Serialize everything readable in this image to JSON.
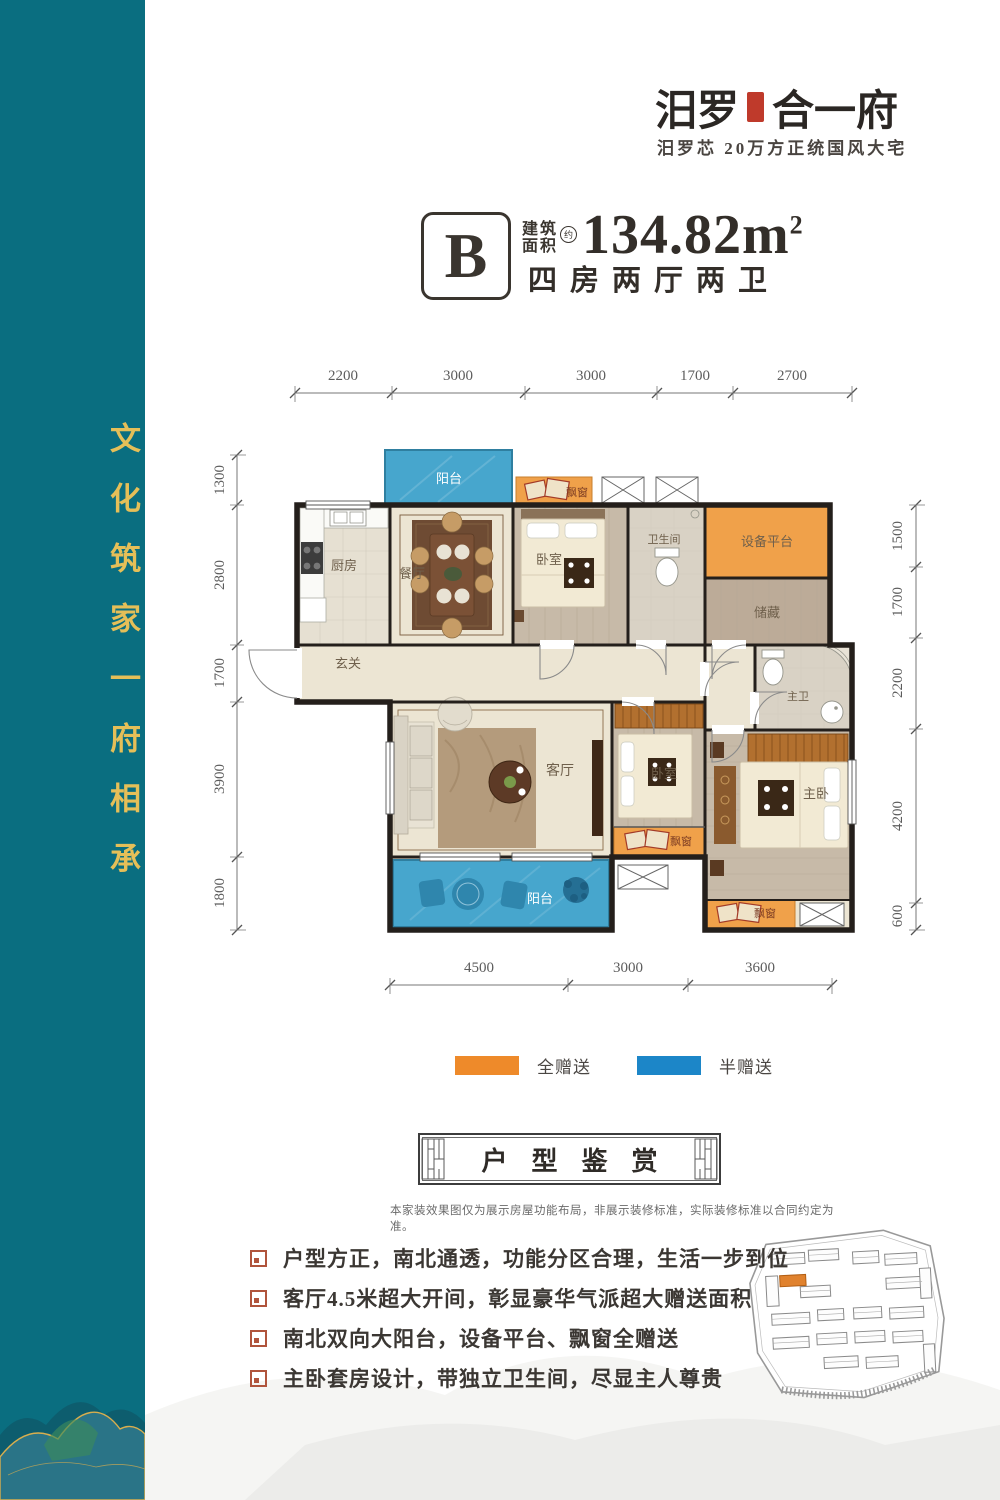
{
  "brand": {
    "logo_left": "汨罗",
    "logo_right": "合一府",
    "tagline": "汨罗芯 20万方正统国风大宅"
  },
  "unit": {
    "type_letter": "B",
    "area_prefix_top": "建筑",
    "area_prefix_bottom": "面积",
    "approx": "约",
    "area_value": "134.82m",
    "area_exponent": "2",
    "layout_text": "四房两厅两卫"
  },
  "sidebar": {
    "slogan": "文化筑家一府相承"
  },
  "plan": {
    "dims": {
      "top": [
        "2200",
        "3000",
        "3000",
        "1700",
        "2700"
      ],
      "left": [
        "1300",
        "2800",
        "1700",
        "3900",
        "1800"
      ],
      "right": [
        "1500",
        "1700",
        "2200",
        "4200",
        "600"
      ],
      "bottom": [
        "4500",
        "3000",
        "3600"
      ]
    },
    "rooms": {
      "balcony_top": "阳台",
      "kitchen": "厨房",
      "dining": "餐厅",
      "bay_top": "飘窗",
      "bedroom_top": "卧室",
      "bathroom": "卫生间",
      "equipment": "设备平台",
      "storage": "储藏",
      "entry": "玄关",
      "living": "客厅",
      "balcony_bottom": "阳台",
      "bedroom_mid": "卧室",
      "bay_mid": "飘窗",
      "master_bath": "主卫",
      "master": "主卧",
      "bay_master": "飘窗"
    }
  },
  "legend": {
    "items": [
      {
        "label": "全赠送",
        "color": "#ee8a2a"
      },
      {
        "label": "半赠送",
        "color": "#1c86c8"
      }
    ]
  },
  "section": {
    "title": "户型鉴赏",
    "disclaimer": "本家装效果图仅为展示房屋功能布局，非展示装修标准，实际装修标准以合同约定为准。"
  },
  "features": [
    "户型方正，南北通透，功能分区合理，生活一步到位",
    "客厅4.5米超大开间，彰显豪华气派超大赠送面积",
    "南北双向大阳台，设备平台、飘窗全赠送",
    "主卧套房设计，带独立卫生间，尽显主人尊贵"
  ],
  "colors": {
    "sidebar_teal": "#0a6e80",
    "gold": "#e5bf58",
    "orange_full": "#ee8a2a",
    "blue_half": "#1c86c8",
    "plan_orange": "#f0a14a",
    "plan_blue": "#47a6cd",
    "wall": "#241f1b"
  }
}
